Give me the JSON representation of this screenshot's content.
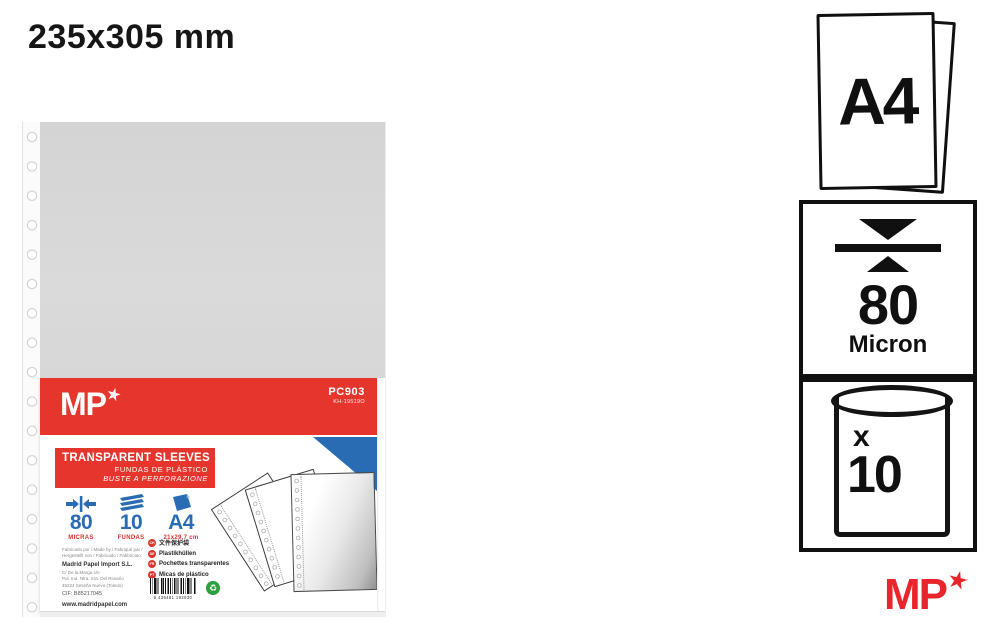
{
  "page": {
    "title": "235x305 mm"
  },
  "colors": {
    "label_red": "#e6352c",
    "brand_red": "#e8252c",
    "accent_blue": "#2a6cb4",
    "sleeve_gray": "#d9d9d9",
    "green_dot_green": "#2f9e3f"
  },
  "product": {
    "brand": "MP",
    "brand_star": "★",
    "sku": "PC903",
    "sku_code": "KH-19519O",
    "title_line1": "TRANSPARENT SLEEVES",
    "title_line2": "FUNDAS DE PLÁSTICO",
    "title_line3": "BUSTE A PERFORAZIONE",
    "specs": [
      {
        "value": "80",
        "label": "MICRAS"
      },
      {
        "value": "10",
        "label": "FUNDAS"
      },
      {
        "value": "A4",
        "label": "21x29,7 cm"
      }
    ],
    "languages": [
      {
        "code": "CH",
        "label": "文件保护袋"
      },
      {
        "code": "DE",
        "label": "Plastikhüllen"
      },
      {
        "code": "FR",
        "label": "Pochettes transparentes"
      },
      {
        "code": "PT",
        "label": "Micas de plástico"
      }
    ],
    "manufacturer": {
      "made_by_line1": "Fabricado por / Made by / Fabriqué par /",
      "made_by_line2": "Hergestellt von / Fabricado / Fabbricato:",
      "name": "Madrid Papel Import S.L.",
      "address1": "C/ De la Marga s/n",
      "address2": "Pol. Ind. Ntra. Sra. Del Rosario",
      "address3": "45224 Seseña Nuevo (Toledo)",
      "cif": "CIF: B85217045",
      "website": "www.madridpapel.com",
      "origin": "Fabricado en China / Made in China / Fabriqué en Chine"
    },
    "barcode_number": "8 435481 192630"
  },
  "info_panel": {
    "format": "A4",
    "thickness_value": "80",
    "thickness_unit": "Micron",
    "quantity_prefix": "x",
    "quantity_value": "10"
  },
  "footer": {
    "brand": "MP",
    "brand_star": "★"
  }
}
